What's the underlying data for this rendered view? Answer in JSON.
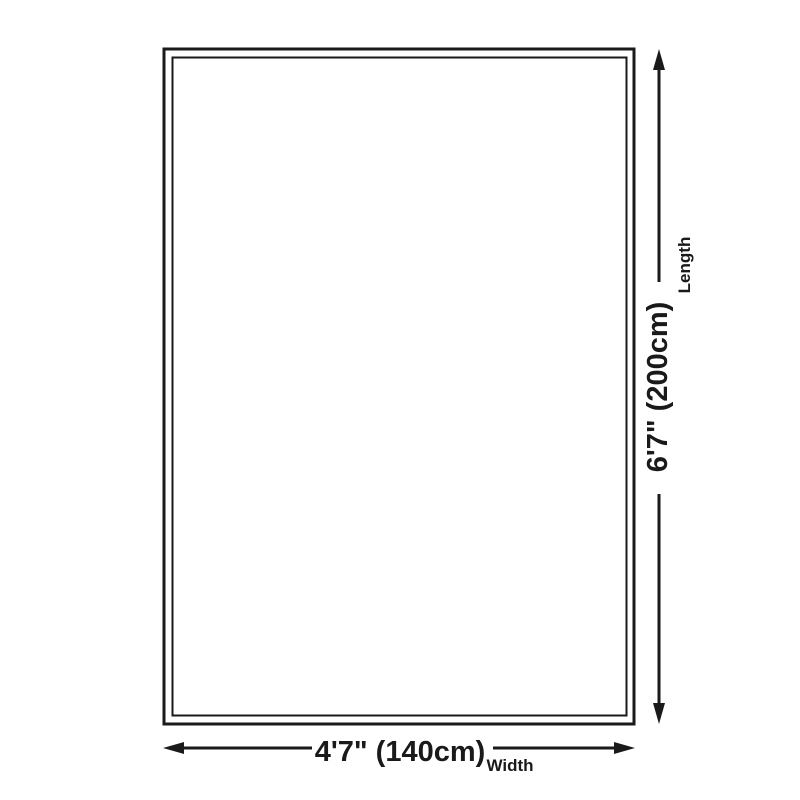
{
  "dimensions": {
    "length": {
      "value": "6'7\" (200cm)",
      "label": "Length"
    },
    "width": {
      "value": "4'7\" (140cm)",
      "label": "Width"
    }
  },
  "colors": {
    "line": "#1a1a1a",
    "background": "#ffffff"
  }
}
